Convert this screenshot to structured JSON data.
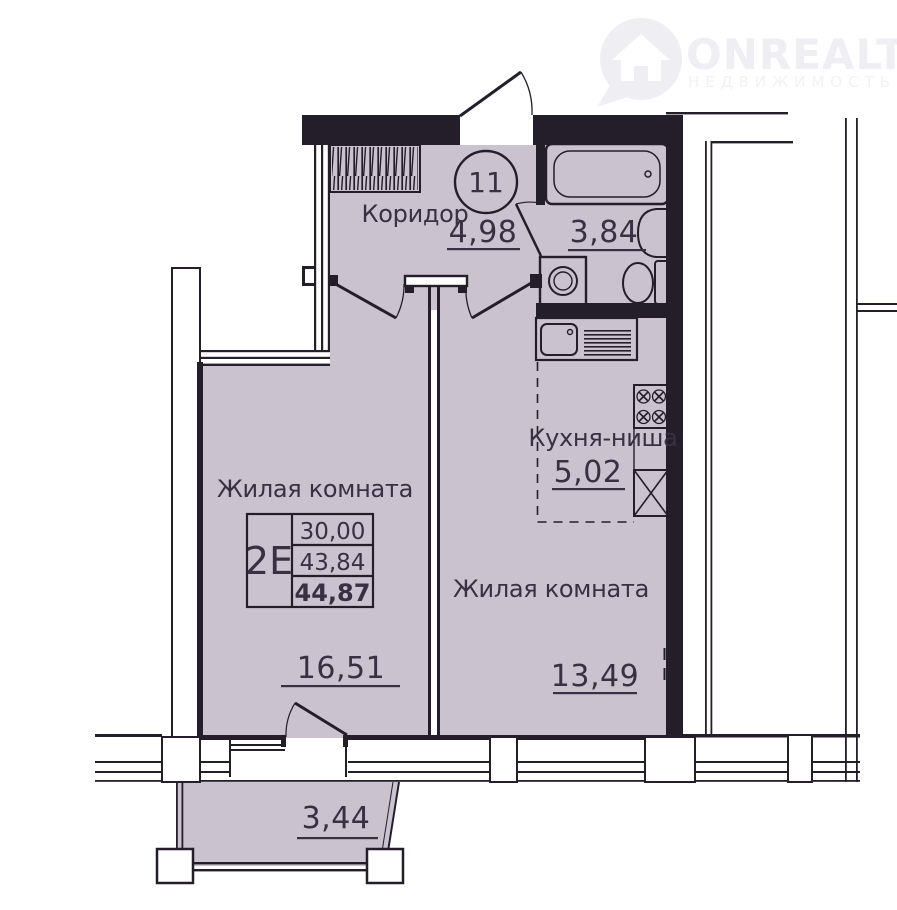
{
  "watermark": {
    "brand": "ONREALT",
    "tagline": "НЕДВИЖИМОСТЬ"
  },
  "apartment": {
    "number": "11",
    "info_box": {
      "type_label": "2Е",
      "living_area": "30,00",
      "area_no_balcony": "43,84",
      "total_area": "44,87"
    },
    "rooms": {
      "corridor": {
        "name": "Коридор",
        "area": "4,98"
      },
      "bathroom": {
        "area": "3,84"
      },
      "kitchen": {
        "name": "Кухня-ниша",
        "area": "5,02"
      },
      "room1": {
        "name": "Жилая комната",
        "area": "16,51"
      },
      "room2": {
        "name": "Жилая комната",
        "area": "13,49"
      },
      "balcony": {
        "area": "3,44"
      }
    },
    "icons": [
      "pin-house-icon",
      "wardrobe-icon",
      "bathtub-icon",
      "sink-icon",
      "toilet-icon",
      "washing-machine-icon",
      "kitchen-sink-icon",
      "stove-icon",
      "fridge-icon"
    ],
    "colors": {
      "floor": "#cbc2d0",
      "wall": "#241e2a",
      "text": "#383043"
    }
  }
}
